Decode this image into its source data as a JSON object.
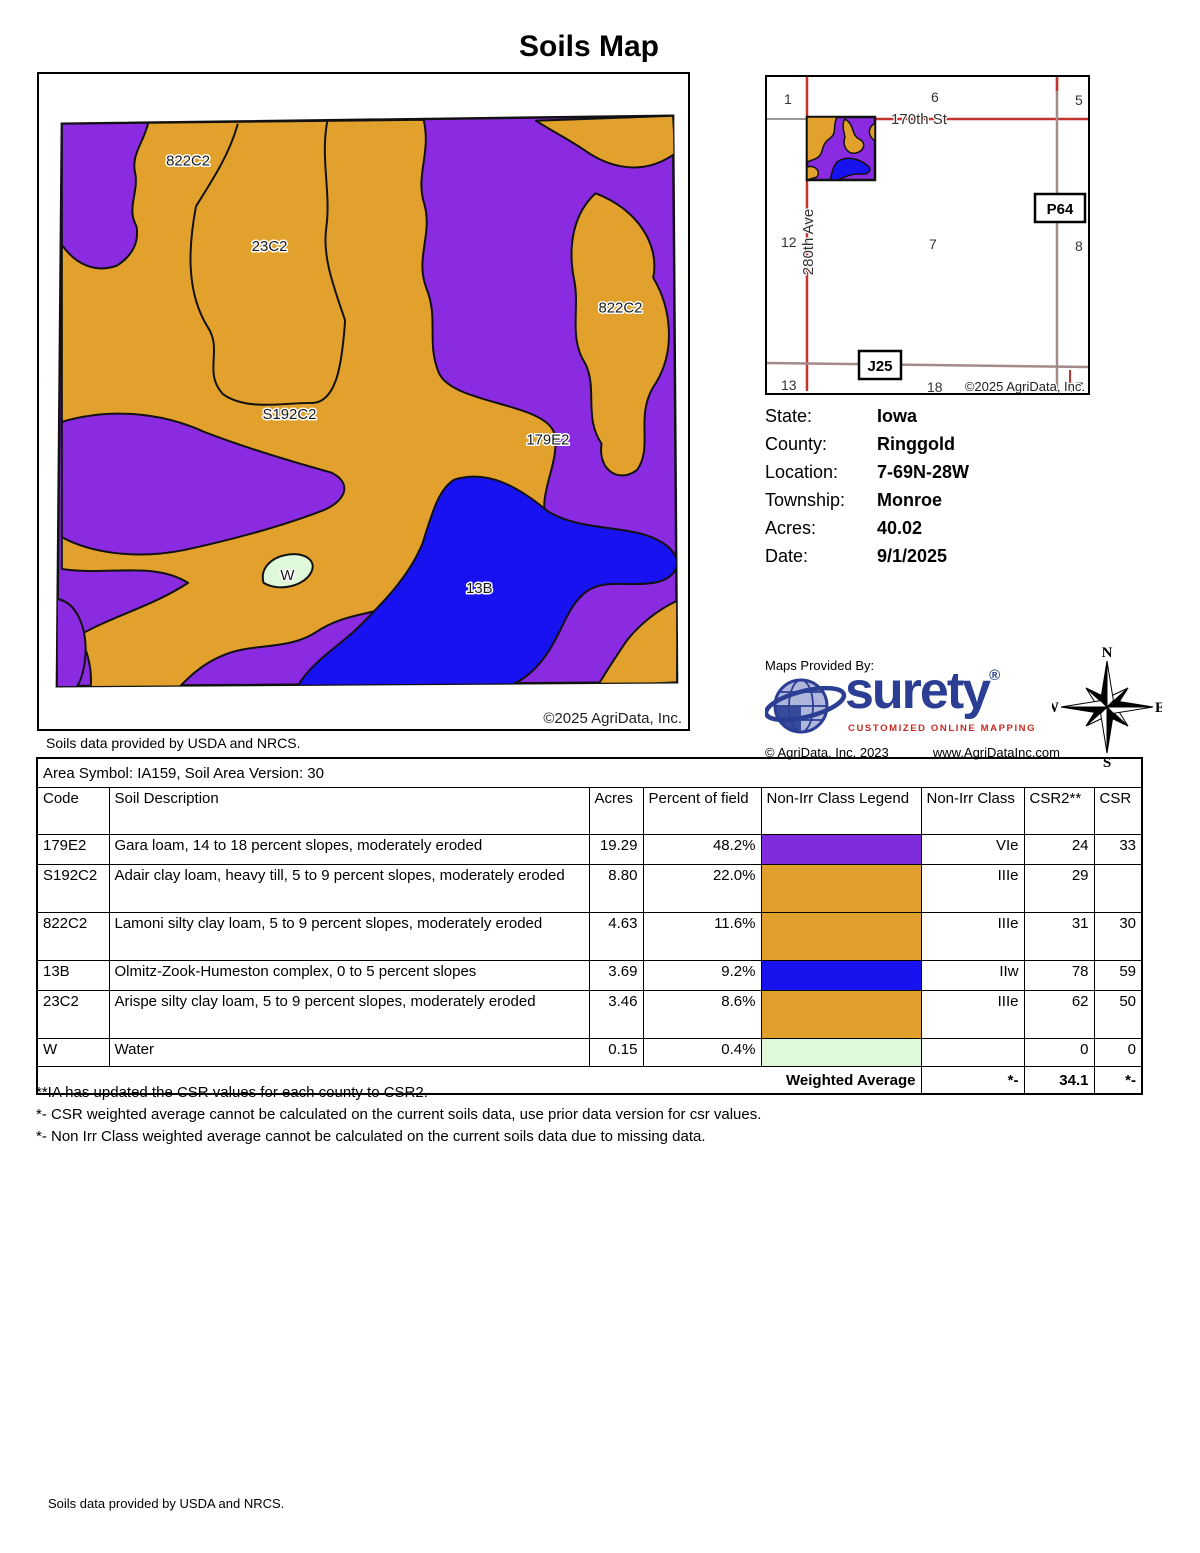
{
  "title": "Soils Map",
  "colors": {
    "purple": "#8A2BE1",
    "orange": "#E2A12C",
    "blue": "#1712EF",
    "water_green": "#DFF8D9",
    "road_red": "#C33431",
    "road_brown": "#A58A8A",
    "road_gray": "#999999",
    "surety_blue": "#2B3E94",
    "surety_red": "#C92A23",
    "globe_light": "#AEB6DC"
  },
  "main_map": {
    "labels": {
      "label_822c2_nw": "822C2",
      "label_23c2": "23C2",
      "label_822c2_e": "822C2",
      "label_s192c2": "S192C2",
      "label_179e2": "179E2",
      "label_13b": "13B",
      "label_w": "W"
    },
    "copyright": "©2025 AgriData, Inc.",
    "caption": "Soils data provided by USDA and NRCS."
  },
  "locator_map": {
    "section_numbers": [
      "1",
      "6",
      "5",
      "12",
      "7",
      "8",
      "13",
      "18",
      "17"
    ],
    "road_st": "170th St",
    "road_ave": "280th Ave",
    "shield_p64": "P64",
    "shield_j25": "J25",
    "copyright": "©2025 AgriData, Inc."
  },
  "info": {
    "rows": [
      {
        "label": "State:",
        "value": "Iowa"
      },
      {
        "label": "County:",
        "value": "Ringgold"
      },
      {
        "label": "Location:",
        "value": "7-69N-28W"
      },
      {
        "label": "Township:",
        "value": "Monroe"
      },
      {
        "label": "Acres:",
        "value": "40.02"
      },
      {
        "label": "Date:",
        "value": "9/1/2025"
      }
    ]
  },
  "provider": {
    "heading": "Maps Provided By:",
    "brand": "surety",
    "reg": "®",
    "tagline": "CUSTOMIZED ONLINE MAPPING",
    "copyright": "© AgriData, Inc. 2023",
    "website": "www.AgriDataInc.com"
  },
  "compass": {
    "n": "N",
    "s": "S",
    "e": "E",
    "w": "W"
  },
  "table": {
    "area_symbol": "Area Symbol: IA159, Soil Area Version: 30",
    "headers": [
      "Code",
      "Soil Description",
      "Acres",
      "Percent of field",
      "Non-Irr Class Legend",
      "Non-Irr Class",
      "CSR2**",
      "CSR"
    ],
    "rows": [
      {
        "code": "179E2",
        "description": "Gara loam, 14 to 18 percent slopes, moderately eroded",
        "acres": "19.29",
        "percent": "48.2%",
        "legend_color": "#7E2CDC",
        "non_irr": "VIe",
        "csr2": "24",
        "csr": "33"
      },
      {
        "code": "S192C2",
        "description": "Adair clay loam, heavy till, 5 to 9 percent slopes, moderately eroded",
        "acres": "8.80",
        "percent": "22.0%",
        "legend_color": "#E0A02B",
        "non_irr": "IIIe",
        "csr2": "29",
        "csr": ""
      },
      {
        "code": "822C2",
        "description": "Lamoni silty clay loam, 5 to 9 percent slopes, moderately eroded",
        "acres": "4.63",
        "percent": "11.6%",
        "legend_color": "#E0A02B",
        "non_irr": "IIIe",
        "csr2": "31",
        "csr": "30"
      },
      {
        "code": "13B",
        "description": "Olmitz-Zook-Humeston complex, 0 to 5 percent slopes",
        "acres": "3.69",
        "percent": "9.2%",
        "legend_color": "#1712EE",
        "non_irr": "IIw",
        "csr2": "78",
        "csr": "59"
      },
      {
        "code": "23C2",
        "description": "Arispe silty clay loam, 5 to 9 percent slopes, moderately eroded",
        "acres": "3.46",
        "percent": "8.6%",
        "legend_color": "#E0A02B",
        "non_irr": "IIIe",
        "csr2": "62",
        "csr": "50"
      },
      {
        "code": "W",
        "description": "Water",
        "acres": "0.15",
        "percent": "0.4%",
        "legend_color": "#DFF8D9",
        "non_irr": "",
        "csr2": "0",
        "csr": "0"
      }
    ],
    "weighted": {
      "label": "Weighted Average",
      "non_irr": "*-",
      "csr2": "34.1",
      "csr": "*-"
    }
  },
  "footnotes": [
    "**IA has updated the CSR values for each county to CSR2.",
    "*- CSR weighted average cannot be calculated on the current soils data, use prior data version for csr values.",
    "*- Non Irr Class weighted average cannot be calculated on the current soils data due to missing data."
  ],
  "footer": "Soils data provided by USDA and NRCS."
}
